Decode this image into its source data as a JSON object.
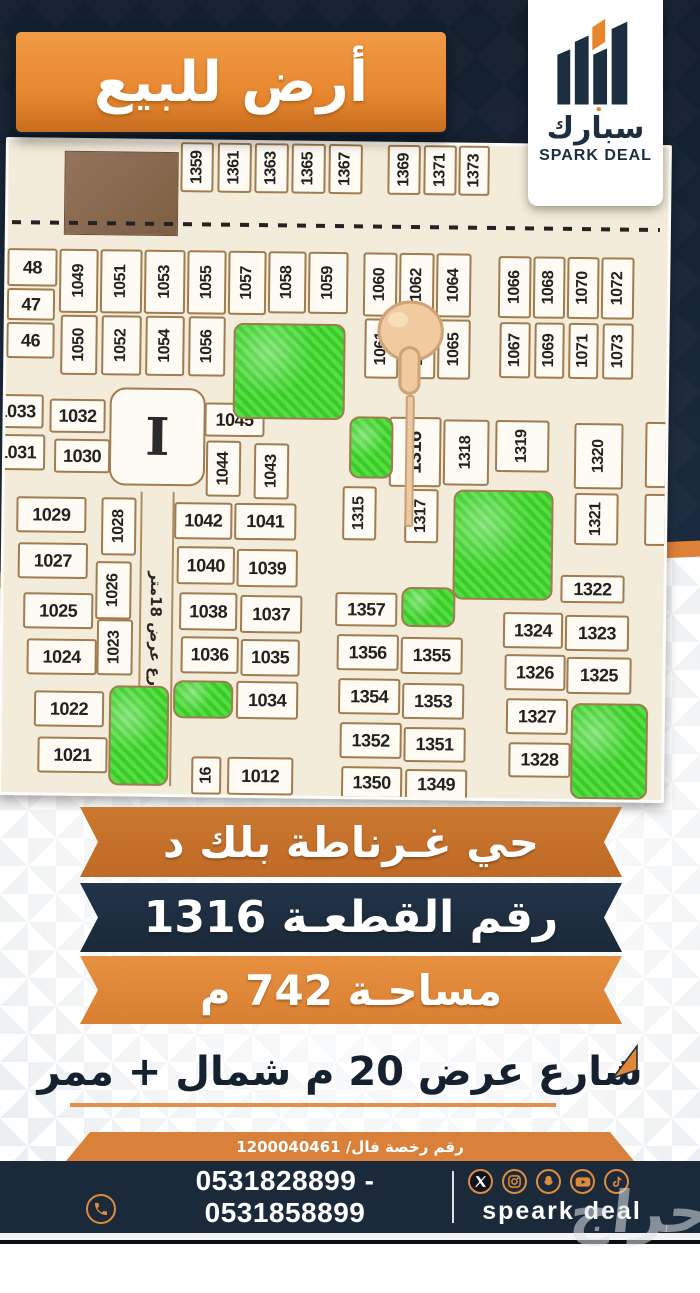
{
  "top_banner": {
    "title": "أرض للبيع"
  },
  "logo": {
    "arabic": "سبارك",
    "english": "SPARK DEAL"
  },
  "map": {
    "street_label": "شارع عرض 18متر",
    "landmark_glyph": "I",
    "pointer_target": "1316",
    "plots": [
      [
        "1359",
        172,
        0,
        33,
        50,
        1
      ],
      [
        "1361",
        209,
        0,
        34,
        50,
        1
      ],
      [
        "1363",
        246,
        0,
        34,
        50,
        1
      ],
      [
        "1365",
        283,
        0,
        34,
        50,
        1
      ],
      [
        "1367",
        320,
        0,
        34,
        50,
        1
      ],
      [
        "1369",
        379,
        0,
        33,
        50,
        1
      ],
      [
        "1371",
        415,
        0,
        33,
        50,
        1
      ],
      [
        "1373",
        450,
        0,
        31,
        50,
        1
      ],
      [
        "48",
        0,
        108,
        50,
        38,
        0
      ],
      [
        "47",
        0,
        148,
        48,
        32,
        0
      ],
      [
        "46",
        0,
        182,
        48,
        36,
        0
      ],
      [
        "1049",
        52,
        108,
        39,
        64,
        1
      ],
      [
        "1050",
        54,
        174,
        37,
        60,
        1
      ],
      [
        "1051",
        93,
        108,
        42,
        64,
        1
      ],
      [
        "1052",
        95,
        174,
        40,
        60,
        1
      ],
      [
        "1053",
        137,
        108,
        41,
        64,
        1
      ],
      [
        "1054",
        139,
        174,
        39,
        60,
        1
      ],
      [
        "1055",
        180,
        108,
        39,
        64,
        1
      ],
      [
        "1056",
        182,
        174,
        37,
        60,
        1
      ],
      [
        "1057",
        221,
        108,
        38,
        64,
        1
      ],
      [
        "1058",
        261,
        108,
        38,
        62,
        1
      ],
      [
        "1059",
        301,
        108,
        40,
        62,
        1
      ],
      [
        "1060",
        356,
        108,
        34,
        64,
        1
      ],
      [
        "1061",
        358,
        174,
        34,
        60,
        1
      ],
      [
        "1062",
        392,
        108,
        35,
        64,
        1
      ],
      [
        "1063",
        394,
        174,
        35,
        60,
        1
      ],
      [
        "1064",
        429,
        108,
        35,
        64,
        1
      ],
      [
        "1065",
        431,
        174,
        33,
        60,
        1
      ],
      [
        "1066",
        491,
        110,
        33,
        62,
        1
      ],
      [
        "1067",
        493,
        176,
        31,
        56,
        1
      ],
      [
        "1068",
        526,
        110,
        32,
        62,
        1
      ],
      [
        "1069",
        528,
        176,
        30,
        56,
        1
      ],
      [
        "1070",
        560,
        110,
        32,
        62,
        1
      ],
      [
        "1071",
        562,
        176,
        30,
        56,
        1
      ],
      [
        "1072",
        594,
        110,
        33,
        62,
        1
      ],
      [
        "1073",
        596,
        176,
        31,
        56,
        1
      ],
      [
        "1033",
        -16,
        254,
        54,
        34,
        0
      ],
      [
        "1032",
        44,
        258,
        56,
        34,
        0
      ],
      [
        "1031",
        -16,
        294,
        56,
        36,
        0
      ],
      [
        "1030",
        49,
        298,
        56,
        34,
        0
      ],
      [
        "1045",
        199,
        260,
        60,
        34,
        0
      ],
      [
        "1044",
        201,
        298,
        35,
        56,
        1
      ],
      [
        "1043",
        249,
        300,
        35,
        56,
        1
      ],
      [
        "1316",
        384,
        272,
        52,
        70,
        2
      ],
      [
        "1318",
        438,
        274,
        46,
        66,
        1
      ],
      [
        "1319",
        490,
        274,
        54,
        52,
        1
      ],
      [
        "1320",
        569,
        276,
        49,
        66,
        1
      ],
      [
        "1315",
        338,
        342,
        34,
        54,
        1
      ],
      [
        "1317",
        400,
        344,
        34,
        54,
        1
      ],
      [
        "1321",
        570,
        346,
        44,
        52,
        1
      ],
      [
        "1029",
        12,
        356,
        70,
        36,
        0
      ],
      [
        "1027",
        14,
        402,
        70,
        36,
        0
      ],
      [
        "1025",
        20,
        452,
        70,
        36,
        0
      ],
      [
        "1024",
        24,
        498,
        70,
        36,
        0
      ],
      [
        "1022",
        32,
        550,
        70,
        36,
        0
      ],
      [
        "1021",
        36,
        596,
        70,
        36,
        0
      ],
      [
        "1028",
        97,
        356,
        35,
        58,
        1
      ],
      [
        "1026",
        92,
        420,
        36,
        58,
        1
      ],
      [
        "1023",
        94,
        478,
        36,
        56,
        1
      ],
      [
        "1042",
        170,
        360,
        58,
        37,
        0
      ],
      [
        "1041",
        230,
        360,
        62,
        37,
        0
      ],
      [
        "1040",
        173,
        404,
        58,
        38,
        0
      ],
      [
        "1039",
        233,
        406,
        61,
        38,
        0
      ],
      [
        "1038",
        176,
        450,
        58,
        38,
        0
      ],
      [
        "1037",
        237,
        452,
        62,
        38,
        0
      ],
      [
        "1036",
        178,
        494,
        58,
        37,
        0
      ],
      [
        "1035",
        238,
        496,
        59,
        37,
        0
      ],
      [
        "1034",
        234,
        538,
        62,
        38,
        0
      ],
      [
        "16",
        190,
        614,
        30,
        38,
        1
      ],
      [
        "1012",
        226,
        614,
        66,
        38,
        0
      ],
      [
        "1357",
        332,
        448,
        62,
        34,
        0
      ],
      [
        "1356",
        334,
        490,
        62,
        36,
        0
      ],
      [
        "1355",
        398,
        492,
        62,
        37,
        0
      ],
      [
        "1354",
        336,
        534,
        62,
        36,
        0
      ],
      [
        "1353",
        400,
        538,
        62,
        36,
        0
      ],
      [
        "1352",
        338,
        578,
        62,
        36,
        0
      ],
      [
        "1351",
        402,
        582,
        62,
        35,
        0
      ],
      [
        "1350",
        340,
        622,
        61,
        32,
        0
      ],
      [
        "1349",
        404,
        624,
        62,
        31,
        0
      ],
      [
        "1322",
        557,
        428,
        64,
        28,
        0
      ],
      [
        "1324",
        500,
        466,
        60,
        36,
        0
      ],
      [
        "1323",
        562,
        468,
        64,
        36,
        0
      ],
      [
        "1326",
        502,
        508,
        61,
        36,
        0
      ],
      [
        "1325",
        564,
        510,
        65,
        37,
        0
      ],
      [
        "1327",
        504,
        552,
        62,
        36,
        0
      ],
      [
        "1328",
        507,
        596,
        62,
        35,
        0
      ],
      [
        "",
        640,
        274,
        22,
        66,
        1
      ],
      [
        "",
        640,
        346,
        22,
        52,
        1
      ]
    ],
    "greens": [
      [
        227,
        180,
        112,
        96
      ],
      [
        344,
        272,
        44,
        62
      ],
      [
        449,
        344,
        100,
        110
      ],
      [
        398,
        442,
        54,
        40
      ],
      [
        171,
        538,
        60,
        38
      ],
      [
        107,
        544,
        60,
        100
      ],
      [
        569,
        556,
        77,
        96
      ]
    ],
    "brown_block": [
      56,
      10,
      112,
      82
    ]
  },
  "banners": [
    {
      "text": "حي غـرناطة بلك د"
    },
    {
      "text": "رقم القطعـة 1316"
    },
    {
      "text": "مساحـة 742 م"
    }
  ],
  "street_note": {
    "text": "شارع عرض 20 م شمال + ممر"
  },
  "license": {
    "text": "رقم رخصة فال/ 1200040461"
  },
  "footer": {
    "phones_line1": "0531828899 - 0531858899",
    "phones_line2": "0531868899 - 0531848899",
    "brand": "speark deal",
    "social": [
      "x",
      "instagram",
      "snapchat",
      "youtube",
      "tiktok"
    ]
  },
  "watermark": {
    "text": "حراج"
  },
  "colors": {
    "accent_orange": "#e0873a",
    "ribbon_brown": "#c4702c",
    "navy": "#1b2a3a",
    "map_bg": "#f3ecdb",
    "map_green": "#46d337",
    "cell_border": "#a07c50"
  }
}
